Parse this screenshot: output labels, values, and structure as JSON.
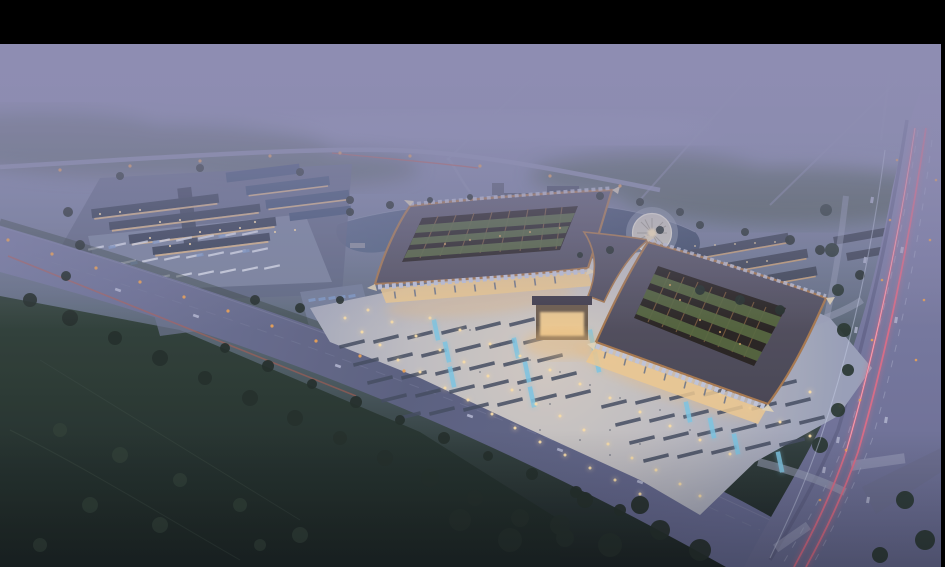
{
  "meta": {
    "description": "Aerial dusk rendering of a large traditional-eave market complex with lit plazas, ponds, fountain, parking campus, misty fields and roads with light trails",
    "width": 945,
    "height": 567,
    "letterbox_top_px": 44,
    "letterbox_right_px": 4
  },
  "palette": {
    "letterbox": "#000000",
    "ground_top": "#8e8db2",
    "ground_upper": "#8689aa",
    "ground_mid": "#78809b",
    "ground_low": "#667184",
    "ground_green": "#4b5a60",
    "ground_dark": "#2c3a36",
    "ground_bottom": "#141d1a",
    "mist": "#8e8db2",
    "haze_streak": "#a7a7cd",
    "forest_haze": "#55635f",
    "forest_haze2": "#4e5d52",
    "field_top": "#2f4036",
    "field_bottom": "#15201b",
    "field_path": "#3c4c40",
    "tree_dark": "#1f2a23",
    "tree_field": "#2b3b30",
    "tree_right": "#24332a",
    "verge": "#33423a",
    "road_far": "#8d91b0",
    "roadA_light": "#787ca0",
    "roadA_mid": "#595e7c",
    "roadA_low": "#666a92",
    "roadA_edge": "#8c90ac",
    "roadA_median": "#7b7f9d",
    "roadB_top": "#8f8cb2",
    "roadB_mid": "#75779c",
    "roadB_low": "#676a90",
    "road_median": "#55587a",
    "lane_dash": "#b8bcd4",
    "branch_road": "#6a6d8e",
    "crosswalk": "#a9adc6",
    "service_road": "#9aa0b6",
    "trail_pink": "#e26a84",
    "trail_pink_core": "#ffb9c4",
    "trail_white": "#c9d2e8",
    "trail_red": "#c05c48",
    "trail_red2": "#c05848",
    "streetlight": "#f0a350",
    "light_warm": "#ffe2a8",
    "plaza_center": "#d6cdc2",
    "plaza_mid": "#c2c0c2",
    "plaza_edge": "#9aa1b8",
    "stall": "#414a5c",
    "pool": "#7ec8e4",
    "people": "#434a5a",
    "pond_light": "#566784",
    "pond_dark": "#39475f",
    "shoreline": "#9aa4b8",
    "pier": "#8a8f9c",
    "fountain_ring": "#cdc9bc",
    "fountain_rim": "#e9e5d5",
    "fountain_spoke": "#a29d8e",
    "fountain_center": "#ffe9b8",
    "fountain_apron": "#9aa3b2",
    "roof_hi": "#5d5a69",
    "roof_lo": "#45424e",
    "roof_trim": "#a9784a",
    "lattice": "#241f1a",
    "rib": "#7d5a36",
    "court_green": "#55683a",
    "eave_tip": "#e8d9b8",
    "sawtooth": "#c3c7da",
    "glass_warm": "#f2cd8f",
    "glow_warm": "#f0bf7a",
    "glint": "#d9a45e",
    "column": "#5d6b86",
    "slate1": "#333d4e",
    "slate2": "#3f5270",
    "lit_line": "#e7bd83",
    "plot": "#5f6780",
    "parking": "#7e88a0",
    "stripe": "#e8ecf4",
    "car_blue": "#7f9cc8",
    "hotel1": "#4b5263",
    "hotel2": "#434a5a",
    "court_warm": "#7a6148",
    "house": "#3d4452",
    "house_lit": "#d8a86e"
  },
  "scene": {
    "plaza_lights": [
      [
        345,
        318
      ],
      [
        362,
        332
      ],
      [
        380,
        345
      ],
      [
        398,
        360
      ],
      [
        420,
        372
      ],
      [
        445,
        388
      ],
      [
        468,
        400
      ],
      [
        492,
        414
      ],
      [
        515,
        428
      ],
      [
        540,
        442
      ],
      [
        565,
        455
      ],
      [
        590,
        468
      ],
      [
        615,
        480
      ],
      [
        640,
        494
      ],
      [
        368,
        310
      ],
      [
        392,
        322
      ],
      [
        416,
        336
      ],
      [
        440,
        350
      ],
      [
        464,
        362
      ],
      [
        488,
        376
      ],
      [
        512,
        390
      ],
      [
        536,
        404
      ],
      [
        560,
        416
      ],
      [
        584,
        430
      ],
      [
        608,
        444
      ],
      [
        632,
        458
      ],
      [
        656,
        470
      ],
      [
        680,
        484
      ],
      [
        430,
        318
      ],
      [
        460,
        330
      ],
      [
        490,
        344
      ],
      [
        520,
        356
      ],
      [
        550,
        370
      ],
      [
        580,
        384
      ],
      [
        610,
        398
      ],
      [
        640,
        412
      ],
      [
        670,
        426
      ],
      [
        700,
        440
      ],
      [
        730,
        454
      ],
      [
        690,
        380
      ],
      [
        720,
        394
      ],
      [
        750,
        408
      ],
      [
        780,
        422
      ],
      [
        810,
        436
      ],
      [
        720,
        350
      ],
      [
        750,
        364
      ],
      [
        780,
        378
      ],
      [
        810,
        392
      ],
      [
        840,
        406
      ],
      [
        700,
        496
      ]
    ],
    "street_lights": [
      [
        8,
        240
      ],
      [
        52,
        254
      ],
      [
        96,
        268
      ],
      [
        140,
        282
      ],
      [
        184,
        297
      ],
      [
        228,
        311
      ],
      [
        272,
        326
      ],
      [
        316,
        341
      ],
      [
        360,
        356
      ],
      [
        404,
        371
      ],
      [
        60,
        170
      ],
      [
        130,
        166
      ],
      [
        200,
        161
      ],
      [
        270,
        156
      ],
      [
        340,
        153
      ],
      [
        410,
        156
      ],
      [
        480,
        166
      ],
      [
        550,
        176
      ],
      [
        620,
        186
      ]
    ],
    "roadB_lights": [
      [
        897,
        160
      ],
      [
        890,
        220
      ],
      [
        882,
        280
      ],
      [
        872,
        340
      ],
      [
        860,
        400
      ],
      [
        846,
        450
      ],
      [
        820,
        500
      ],
      [
        936,
        180
      ],
      [
        930,
        240
      ],
      [
        924,
        300
      ],
      [
        916,
        360
      ]
    ],
    "stall_dashes": [
      [
        352,
        344
      ],
      [
        386,
        339
      ],
      [
        420,
        335
      ],
      [
        454,
        330
      ],
      [
        488,
        326
      ],
      [
        522,
        322
      ],
      [
        366,
        362
      ],
      [
        400,
        357
      ],
      [
        434,
        353
      ],
      [
        468,
        348
      ],
      [
        502,
        344
      ],
      [
        536,
        340
      ],
      [
        380,
        380
      ],
      [
        414,
        375
      ],
      [
        448,
        371
      ],
      [
        482,
        366
      ],
      [
        516,
        362
      ],
      [
        550,
        358
      ],
      [
        394,
        398
      ],
      [
        428,
        393
      ],
      [
        462,
        389
      ],
      [
        496,
        384
      ],
      [
        530,
        380
      ],
      [
        564,
        376
      ],
      [
        408,
        416
      ],
      [
        442,
        411
      ],
      [
        476,
        407
      ],
      [
        510,
        402
      ],
      [
        544,
        398
      ],
      [
        578,
        394
      ],
      [
        614,
        404
      ],
      [
        648,
        400
      ],
      [
        682,
        396
      ],
      [
        716,
        392
      ],
      [
        750,
        388
      ],
      [
        784,
        384
      ],
      [
        628,
        422
      ],
      [
        662,
        418
      ],
      [
        696,
        414
      ],
      [
        730,
        410
      ],
      [
        764,
        406
      ],
      [
        798,
        402
      ],
      [
        642,
        440
      ],
      [
        676,
        436
      ],
      [
        710,
        432
      ],
      [
        744,
        428
      ],
      [
        778,
        424
      ],
      [
        812,
        420
      ],
      [
        656,
        458
      ],
      [
        690,
        454
      ],
      [
        724,
        450
      ],
      [
        758,
        446
      ],
      [
        792,
        442
      ]
    ],
    "pool_cascades": [
      [
        447,
        352
      ],
      [
        452,
        377
      ],
      [
        527,
        372
      ],
      [
        532,
        397
      ],
      [
        592,
        340
      ],
      [
        597,
        362
      ],
      [
        688,
        412
      ],
      [
        712,
        428
      ],
      [
        736,
        444
      ],
      [
        780,
        462
      ],
      [
        436,
        330
      ],
      [
        516,
        348
      ]
    ],
    "people": [
      [
        470,
        330
      ],
      [
        500,
        345
      ],
      [
        530,
        360
      ],
      [
        560,
        372
      ],
      [
        590,
        385
      ],
      [
        620,
        398
      ],
      [
        520,
        390
      ],
      [
        550,
        404
      ],
      [
        480,
        372
      ],
      [
        610,
        430
      ],
      [
        640,
        444
      ],
      [
        660,
        410
      ],
      [
        690,
        430
      ],
      [
        580,
        440
      ],
      [
        610,
        455
      ],
      [
        540,
        430
      ]
    ],
    "parking_stripes": [
      [
        96,
        248
      ],
      [
        118,
        245
      ],
      [
        140,
        243
      ],
      [
        162,
        241
      ],
      [
        184,
        239
      ],
      [
        206,
        237
      ],
      [
        228,
        235
      ],
      [
        250,
        233
      ],
      [
        106,
        264
      ],
      [
        128,
        262
      ],
      [
        150,
        260
      ],
      [
        172,
        258
      ],
      [
        194,
        256
      ],
      [
        216,
        254
      ],
      [
        238,
        252
      ],
      [
        260,
        250
      ],
      [
        118,
        281
      ],
      [
        140,
        279
      ],
      [
        162,
        277
      ],
      [
        184,
        275
      ],
      [
        206,
        273
      ],
      [
        228,
        271
      ],
      [
        250,
        269
      ],
      [
        272,
        267
      ]
    ],
    "parked_cars": [
      [
        312,
        300
      ],
      [
        322,
        299
      ],
      [
        332,
        298
      ],
      [
        342,
        297
      ],
      [
        352,
        296
      ],
      [
        316,
        310
      ],
      [
        326,
        309
      ],
      [
        336,
        308
      ],
      [
        346,
        307
      ],
      [
        356,
        306
      ],
      [
        112,
        247
      ],
      [
        156,
        242
      ],
      [
        222,
        236
      ],
      [
        134,
        263
      ],
      [
        200,
        255
      ],
      [
        246,
        251
      ]
    ],
    "cars_roadA": [
      [
        118,
        290
      ],
      [
        196,
        316
      ],
      [
        338,
        366
      ],
      [
        470,
        416
      ],
      [
        560,
        450
      ],
      [
        640,
        482
      ]
    ],
    "cars_roadB": [
      [
        872,
        200
      ],
      [
        865,
        260
      ],
      [
        902,
        250
      ],
      [
        896,
        320
      ],
      [
        856,
        330
      ],
      [
        846,
        390
      ],
      [
        886,
        420
      ],
      [
        838,
        440
      ],
      [
        824,
        470
      ],
      [
        868,
        500
      ]
    ],
    "columns_left": [
      [
        395,
        295
      ],
      [
        415,
        293
      ],
      [
        435,
        291
      ],
      [
        455,
        289
      ],
      [
        475,
        288
      ],
      [
        495,
        286
      ],
      [
        515,
        284
      ],
      [
        535,
        282
      ],
      [
        555,
        280
      ]
    ],
    "columns_right": [
      [
        605,
        355
      ],
      [
        625,
        362
      ],
      [
        645,
        370
      ],
      [
        665,
        377
      ],
      [
        685,
        385
      ],
      [
        705,
        392
      ],
      [
        725,
        400
      ]
    ],
    "glints": [
      [
        470,
        240
      ],
      [
        500,
        236
      ],
      [
        530,
        232
      ],
      [
        445,
        244
      ],
      [
        560,
        228
      ],
      [
        680,
        300
      ],
      [
        700,
        320
      ],
      [
        720,
        332
      ],
      [
        740,
        344
      ],
      [
        670,
        285
      ]
    ],
    "hotel_windows": [
      [
        505,
        210
      ],
      [
        513,
        212
      ],
      [
        521,
        214
      ],
      [
        529,
        216
      ],
      [
        552,
        206
      ],
      [
        560,
        208
      ],
      [
        568,
        210
      ],
      [
        548,
        196
      ]
    ],
    "house_windows": [
      [
        695,
        246
      ],
      [
        715,
        245
      ],
      [
        735,
        244
      ],
      [
        755,
        243
      ],
      [
        775,
        242
      ],
      [
        707,
        264
      ],
      [
        727,
        263
      ],
      [
        747,
        262
      ],
      [
        767,
        261
      ],
      [
        719,
        282
      ],
      [
        739,
        281
      ],
      [
        759,
        280
      ]
    ],
    "campus_windows": [
      [
        100,
        214
      ],
      [
        120,
        212
      ],
      [
        140,
        210
      ],
      [
        160,
        222
      ],
      [
        180,
        220
      ],
      [
        200,
        232
      ],
      [
        220,
        230
      ],
      [
        240,
        228
      ],
      [
        150,
        238
      ],
      [
        170,
        246
      ],
      [
        190,
        244
      ],
      [
        255,
        222
      ],
      [
        275,
        232
      ],
      [
        295,
        230
      ]
    ],
    "trees_main": [
      [
        30,
        300,
        7
      ],
      [
        70,
        318,
        8
      ],
      [
        115,
        338,
        7
      ],
      [
        160,
        358,
        8
      ],
      [
        205,
        378,
        7
      ],
      [
        250,
        398,
        8
      ],
      [
        295,
        418,
        8
      ],
      [
        340,
        438,
        7
      ],
      [
        385,
        458,
        8
      ],
      [
        430,
        478,
        9
      ],
      [
        475,
        498,
        8
      ],
      [
        520,
        518,
        9
      ],
      [
        565,
        538,
        9
      ],
      [
        225,
        348,
        5
      ],
      [
        268,
        366,
        6
      ],
      [
        312,
        384,
        5
      ],
      [
        356,
        402,
        6
      ],
      [
        400,
        420,
        5
      ],
      [
        444,
        438,
        6
      ],
      [
        488,
        456,
        5
      ],
      [
        532,
        474,
        6
      ],
      [
        576,
        492,
        6
      ],
      [
        620,
        510,
        6
      ],
      [
        460,
        520,
        11
      ],
      [
        510,
        540,
        12
      ],
      [
        560,
        525,
        10
      ],
      [
        610,
        545,
        12
      ],
      [
        660,
        530,
        10
      ],
      [
        700,
        550,
        11
      ],
      [
        640,
        505,
        9
      ],
      [
        585,
        500,
        8
      ],
      [
        350,
        212,
        4
      ],
      [
        390,
        205,
        4
      ],
      [
        430,
        200,
        3
      ],
      [
        470,
        197,
        3
      ],
      [
        600,
        196,
        4
      ],
      [
        640,
        202,
        4
      ],
      [
        680,
        212,
        4
      ],
      [
        610,
        250,
        4
      ],
      [
        580,
        255,
        3
      ],
      [
        68,
        212,
        5
      ],
      [
        80,
        245,
        5
      ],
      [
        66,
        276,
        5
      ],
      [
        255,
        300,
        5
      ],
      [
        300,
        308,
        5
      ],
      [
        340,
        300,
        4
      ],
      [
        350,
        200,
        4
      ],
      [
        300,
        172,
        4
      ],
      [
        200,
        168,
        4
      ],
      [
        120,
        176,
        4
      ],
      [
        660,
        230,
        4
      ],
      [
        700,
        225,
        4
      ],
      [
        745,
        232,
        4
      ],
      [
        790,
        240,
        5
      ],
      [
        820,
        250,
        5
      ],
      [
        860,
        275,
        5
      ],
      [
        700,
        290,
        5
      ],
      [
        740,
        300,
        5
      ],
      [
        780,
        310,
        5
      ]
    ],
    "trees_field": [
      [
        60,
        430,
        7
      ],
      [
        120,
        455,
        8
      ],
      [
        180,
        480,
        7
      ],
      [
        90,
        505,
        8
      ],
      [
        160,
        525,
        8
      ],
      [
        240,
        505,
        7
      ],
      [
        300,
        535,
        8
      ],
      [
        40,
        545,
        7
      ],
      [
        260,
        545,
        6
      ]
    ],
    "trees_right": [
      [
        826,
        210,
        6
      ],
      [
        832,
        250,
        7
      ],
      [
        838,
        290,
        6
      ],
      [
        844,
        330,
        7
      ],
      [
        848,
        370,
        6
      ],
      [
        838,
        410,
        7
      ],
      [
        820,
        445,
        8
      ],
      [
        905,
        500,
        9
      ],
      [
        925,
        540,
        10
      ],
      [
        880,
        555,
        8
      ]
    ]
  }
}
